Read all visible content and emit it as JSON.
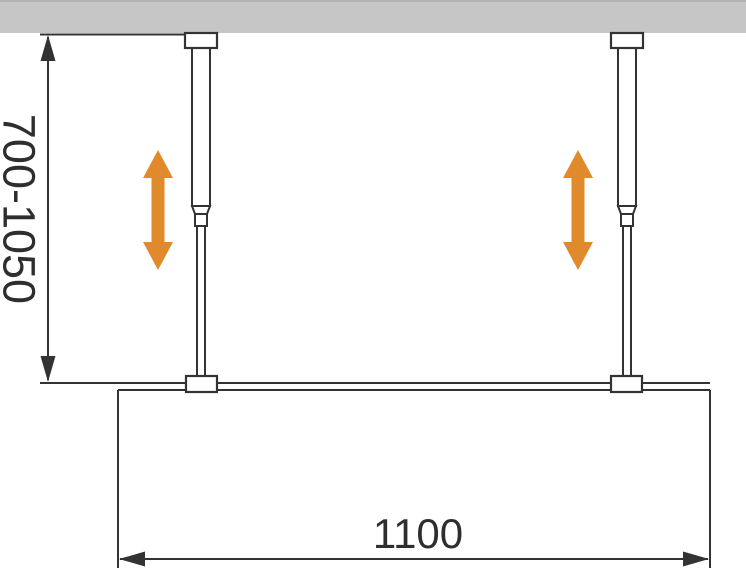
{
  "diagram": {
    "type": "installation-diagram",
    "dimensions": {
      "vertical": {
        "label": "700-1050"
      },
      "horizontal": {
        "label": "1100"
      }
    },
    "icons": {
      "left_adjust": "double-vertical-arrow",
      "right_adjust": "double-vertical-arrow",
      "dimension_arrows": [
        "arrow-up",
        "arrow-down",
        "arrow-left",
        "arrow-right"
      ]
    },
    "colors": {
      "accent_orange": "#E08A2B",
      "ceiling_gray": "#C6C6C6",
      "line_dark": "#333333",
      "background": "#FFFFFF"
    }
  }
}
